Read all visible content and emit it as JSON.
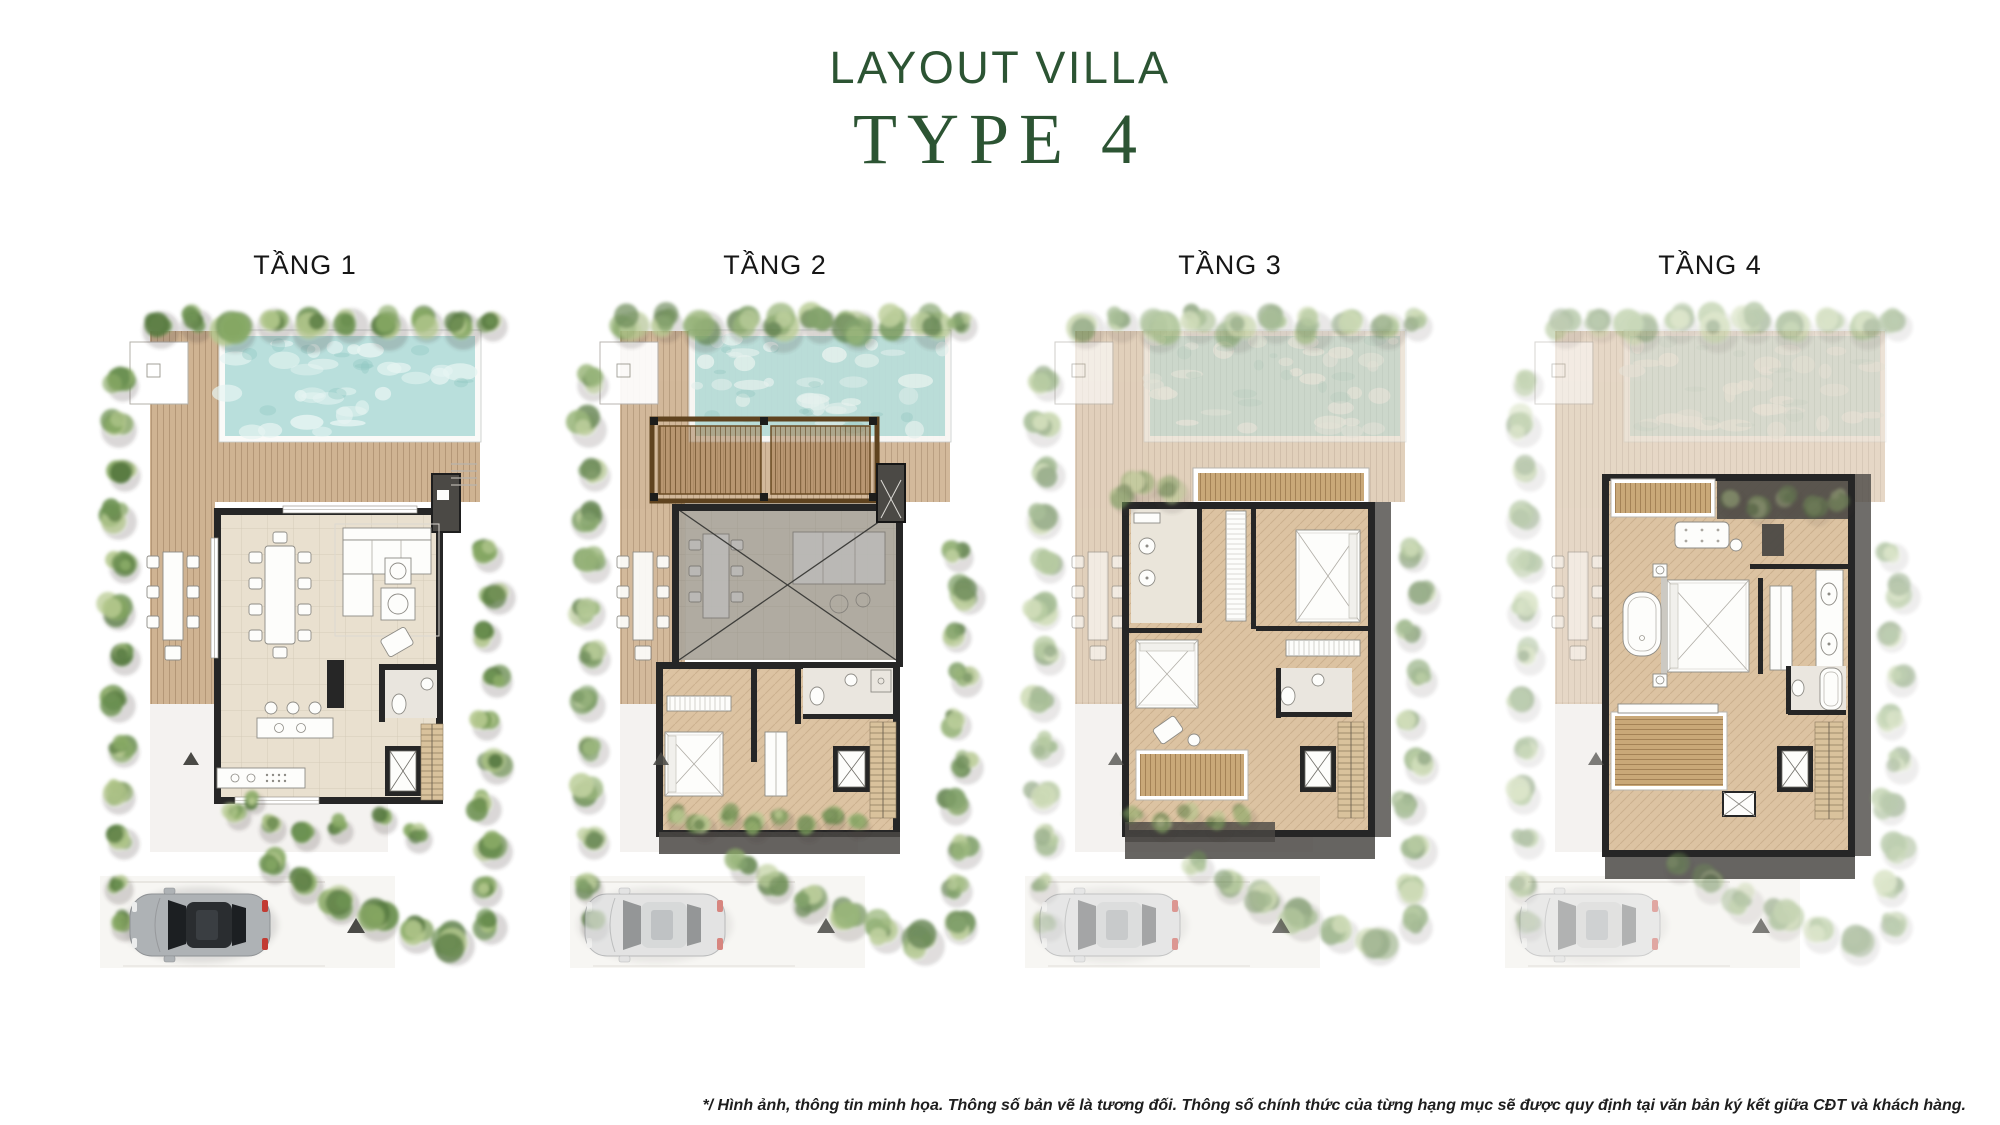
{
  "header": {
    "title": "LAYOUT VILLA",
    "subtitle": "TYPE 4"
  },
  "floors": [
    {
      "label": "TẦNG 1"
    },
    {
      "label": "TẦNG 2"
    },
    {
      "label": "TẦNG 3"
    },
    {
      "label": "TẦNG 4"
    }
  ],
  "footer": {
    "disclaimer": "*/ Hình ảnh, thông tin minh họa. Thông số bản vẽ là tương đối. Thông số chính thức của từng hạng mục sẽ được quy định tại văn bản ký kết giữa CĐT và khách hàng."
  },
  "palette": {
    "title_green": "#2c5433",
    "label_dark": "#161616",
    "disclaimer_dark": "#1e1e1e",
    "pool_water": "#b9dfdc",
    "pool_water_light": "#e6f4f2",
    "pool_water_deep": "#8cc7c1",
    "deck_wood": "#cfb392",
    "interior_tile": "#e9e0cf",
    "interior_wood": "#dcc3a2",
    "stair_wood": "#d9c29c",
    "wall_dark": "#262626",
    "poche_gray": "#4b4945",
    "pergola_wood": "#a27a4e",
    "balcony_wood": "#c9a878",
    "green_dark": "#55783f",
    "green_mid": "#6e9353",
    "green_light": "#8aab67",
    "green_pale": "#b5c98f",
    "car_red": "#c23b33",
    "marker_gray": "#4a4a46",
    "pavement": "#efede9"
  }
}
